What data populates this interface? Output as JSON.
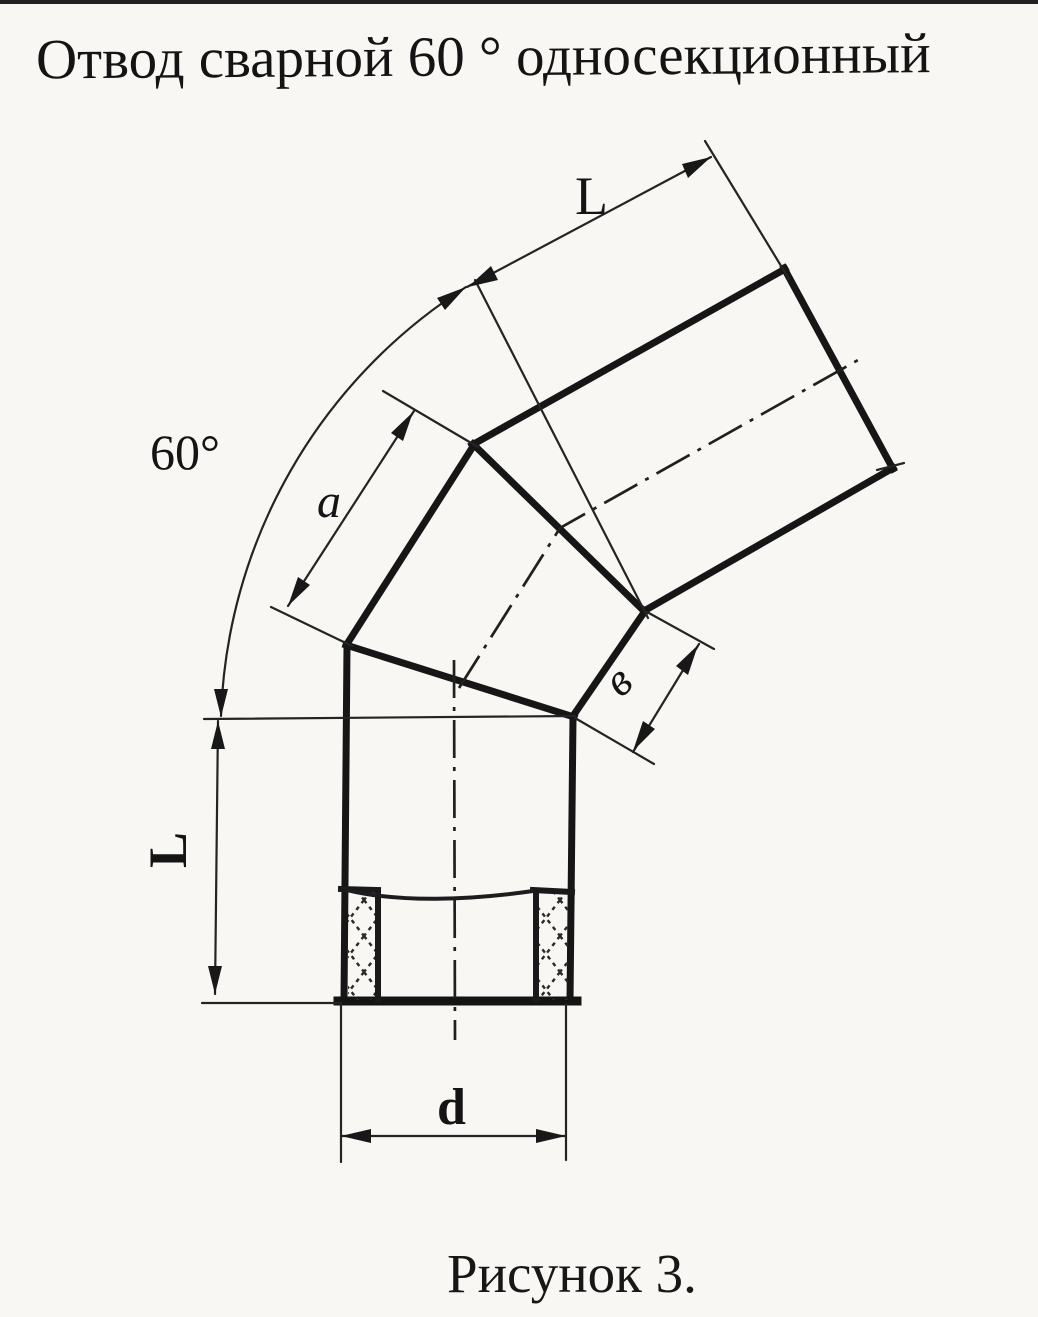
{
  "title": "Отвод сварной 60 ° односекционный",
  "caption": "Рисунок 3.",
  "drawing": {
    "description": "Чертёж отвода сварного 60° односекционного",
    "labels": {
      "bend_angle": "60°",
      "top_segment_length": "L",
      "intermediate_section_side": "a",
      "intermediate_section_width": "в",
      "bottom_segment_length": "L",
      "diameter": "d"
    }
  },
  "colors": {
    "ink": "#161616",
    "paper": "#f8f7f4"
  }
}
